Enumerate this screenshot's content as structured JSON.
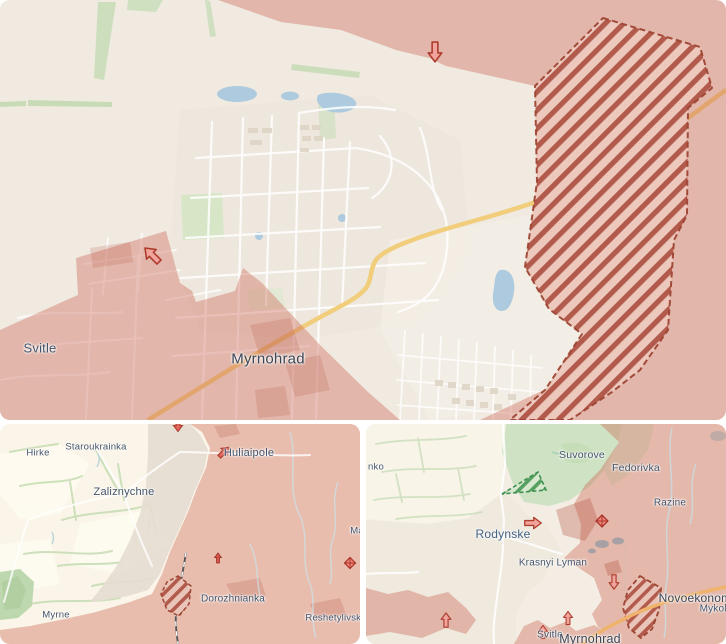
{
  "page": {
    "description": "Frontline map collage: Myrnohrad overview plus Zaliznychne and Rodynske sector maps",
    "background": "#ffffff"
  },
  "colors": {
    "occupied_overlay": "#cd6a57",
    "advance_hatch_stripe": "#b25a4b",
    "advance_hatch_background": "#ecc8bd",
    "zone_dashed_border": "#9e4533",
    "green_hatch_stripe": "#57a063",
    "forest": "#cfe3c4",
    "water": "#adcadf",
    "primary_road": "#f1cd7c",
    "secondary_road_orange": "#efb36b",
    "label_text": "#44536a"
  },
  "maps": {
    "top": {
      "name": "myrnohrad-overview-map",
      "labels": [
        {
          "text": "Svitle"
        },
        {
          "text": "Myrnohrad"
        }
      ],
      "zones": [
        "occupied",
        "claimed-advance-hatched"
      ],
      "icons": [
        "advance-arrow-down",
        "advance-arrow-northeast"
      ]
    },
    "bottom_left": {
      "name": "zaliznychne-sector-map",
      "labels": [
        {
          "text": "Hirke"
        },
        {
          "text": "Staroukrainka"
        },
        {
          "text": "Zaliznychne"
        },
        {
          "text": "Huliaipole"
        },
        {
          "text": "Dorozhnianka"
        },
        {
          "text": "Reshetylivske"
        },
        {
          "text": "Myrne"
        },
        {
          "text": "Ma"
        }
      ],
      "zones": [
        "occupied",
        "contested-hatched",
        "gray-buffer"
      ],
      "icons": [
        "advance-arrow",
        "clash-diamond",
        "railway"
      ]
    },
    "bottom_right": {
      "name": "rodynske-sector-map",
      "labels": [
        {
          "text": "nko"
        },
        {
          "text": "Suvorove"
        },
        {
          "text": "Fedorivka"
        },
        {
          "text": "Razine"
        },
        {
          "text": "Rodynske"
        },
        {
          "text": "Krasnyi Lyman"
        },
        {
          "text": "Novoekonomich"
        },
        {
          "text": "Mykola"
        },
        {
          "text": "Svitle"
        },
        {
          "text": "Myrnohrad"
        }
      ],
      "zones": [
        "occupied",
        "contested-hatched",
        "green-recaptured-hatched"
      ],
      "icons": [
        "advance-arrow-left",
        "advance-arrow-down",
        "advance-arrow-up",
        "clash-diamond"
      ]
    }
  }
}
